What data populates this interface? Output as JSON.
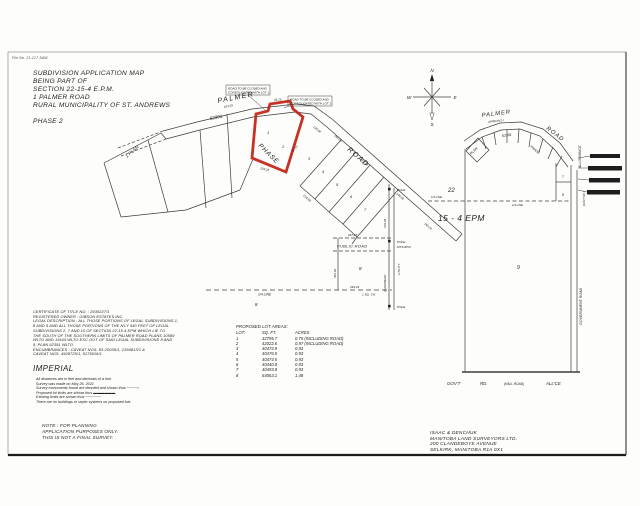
{
  "sheet": {
    "file_no": "File No. 21-217 SAW"
  },
  "title_block": {
    "lines": [
      "SUBDIVISION APPLICATION MAP",
      "BEING PART OF",
      "SECTION 22-15-4 E.P.M.",
      "1 PALMER ROAD",
      "RURAL MUNICIPALITY OF ST. ANDREWS"
    ],
    "phase": "PHASE 2"
  },
  "certificate": {
    "lines": [
      "CERTIFICATE OF TITLE NO. : 2939227/1",
      "REGISTERED OWNER : GIBSON ESTATES INC.",
      "LEGAL DESCRIPTION : ALL THOSE PORTIONS OF LEGAL SUBDIVISIONS 1,",
      "8 AND 9 AND ALL THOSE PORTIONS OF THE N'LY 440 FEET OF LEGAL",
      "SUBDIVISIONS 2, 7 AND 10 OF SECTION 22-15-4 EPM WHICH LIE TO",
      "THE SOUTH OF THE SOUTHERN LIMITS OF PALMER ROAD PLANS 10589",
      "WLTO AND 11544 WLTO EXC OUT OF SAID LEGAL SUBDIVISIONS 8 AND",
      "9, PLAN 62391 WLTO",
      "ENCUMBRANCES : CAVEAT NOS. 83-20035/1, 2394813/1 &",
      "CAVEAT NOS. 4928725/1, 5175616/1"
    ]
  },
  "imperial": {
    "heading": "IMPERIAL",
    "notes": [
      "All distances are in feet and decimals of a foot",
      "Survey was made on May 26, 2021",
      "Survey monuments found are denoted and shown thus ────○",
      "Proposed lot limits are shown thus ▬▬▬▬▬▬",
      "Existing limits are shown thus ──────",
      "There are no buildings or septic systems on proposed lots"
    ]
  },
  "note_block": {
    "lines": [
      "NOTE :  FOR PLANNING",
      "APPLICATION PURPOSES ONLY.",
      "THIS IS NOT A FINAL SURVEY."
    ]
  },
  "surveyor": {
    "lines": [
      "ISAAC & DENCHUK",
      "MANITOBA LAND SURVEYORS LTD.",
      "200 CLANDEBOYE AVENUE",
      "SELKIRK, MANITOBA   R1A 0X1"
    ]
  },
  "lot_table": {
    "title": "PROPOSED LOT AREAS:",
    "headers": [
      "LOT:",
      "SQ. FT.",
      "ACRES"
    ],
    "rows": [
      [
        "1",
        "32795.7",
        "0.75 (INCLUDING ROAD)"
      ],
      [
        "2",
        "42022.6",
        "0.97 (INCLUDING ROAD)"
      ],
      [
        "3",
        "40472.9",
        "0.93"
      ],
      [
        "4",
        "40476.5",
        "0.93"
      ],
      [
        "5",
        "40474.5",
        "0.93"
      ],
      [
        "6",
        "40440.8",
        "0.93"
      ],
      [
        "7",
        "40493.8",
        "0.93"
      ],
      [
        "8",
        "64063.1",
        "1.48"
      ]
    ]
  },
  "left_map": {
    "palmer": "PALMER",
    "road": "ROAD",
    "plan_no": "62391",
    "plan_label": "1 PLAN",
    "phase_label": "PHASE",
    "callout1_l1": "ROAD TO BE CLOSED AND",
    "callout1_l2": "CONSOLIDATED WITH LOT 1",
    "callout2_l1": "ROAD TO BE CLOSED AND",
    "callout2_l2": "CONSOLIDATED WITH LOT 2",
    "public_road": "PUBLIC ROAD",
    "quarter_line": "1/4 LINE",
    "pole": "POLE",
    "mts_box": "MTS BOX",
    "utility": "UTILITY",
    "overhead": "OVERHEAD",
    "sq_ch": "1 SQ. CH.",
    "ls8": "8",
    "lots": [
      "1",
      "2",
      "3",
      "4",
      "5",
      "6",
      "7",
      "8"
    ],
    "dims": [
      "103.29",
      "45.26",
      "150.25",
      "203.93",
      "144.99",
      "104.94",
      "345.62",
      "267.27",
      "293.23",
      "129.35",
      "57.13",
      "125.98",
      "214.95",
      "150.03"
    ]
  },
  "right_map": {
    "palmer": "PALMER",
    "approach": "APPROACH",
    "road": "ROAD",
    "plan_no": "62391",
    "plan": "PLAN",
    "phase": "PHASE",
    "allowance": "ALLOWANCE",
    "govt_rd_vert": "(GOV'T RD.)",
    "government_road": "GOVERNMENT ROAD",
    "section": "22",
    "quarter_line": "1/4 LINE",
    "township": "15 - 4 EPM",
    "parcel": "9",
    "lot7": "7",
    "lot8": "8",
    "bottom": [
      "GOV'T",
      "RD.",
      "(HALL ROAD)",
      "ALL'CE"
    ],
    "compass": {
      "n": "N",
      "e": "E",
      "s": "S",
      "w": "W"
    }
  },
  "colors": {
    "highlight": "#c4271a",
    "line": "#3c3c3c",
    "paper": "#fdfdfb"
  }
}
